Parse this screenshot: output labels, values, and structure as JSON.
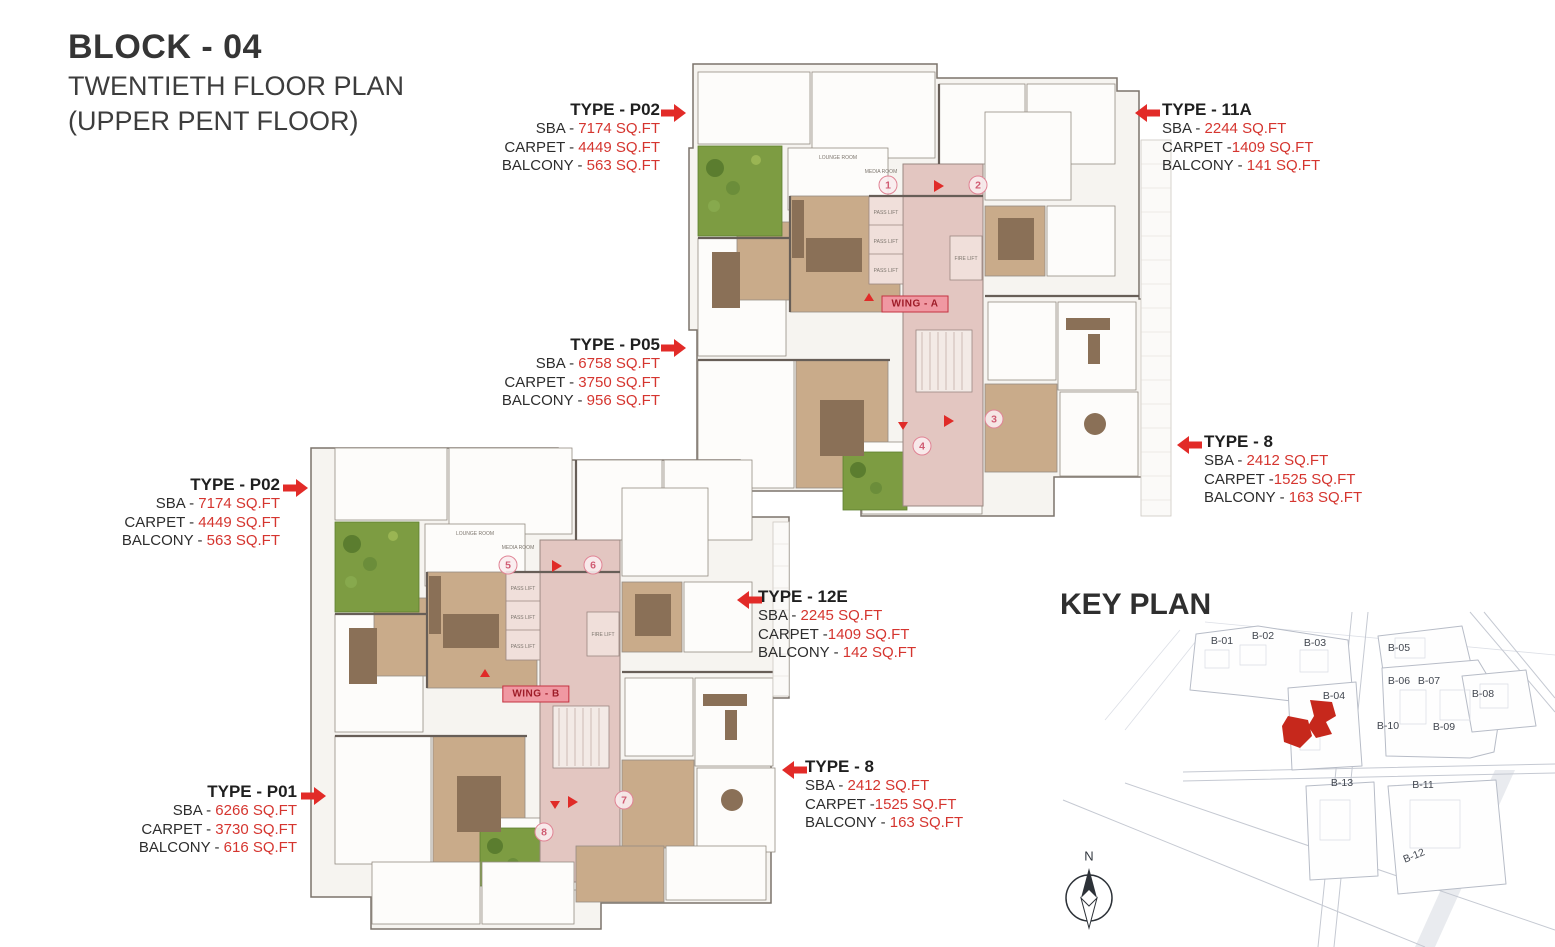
{
  "page": {
    "block_title": "BLOCK - 04",
    "floor_title": "TWENTIETH FLOOR PLAN",
    "floor_subtitle": "(UPPER PENT FLOOR)"
  },
  "callouts": [
    {
      "type": "TYPE - P02",
      "sba_label": "SBA - ",
      "sba_value": "7174 SQ.FT",
      "carpet_label": "CARPET - ",
      "carpet_value": "4449 SQ.FT",
      "balcony_label": "BALCONY - ",
      "balcony_value": "563 SQ.FT"
    },
    {
      "type": "TYPE - 11A",
      "sba_label": "SBA - ",
      "sba_value": "2244 SQ.FT",
      "carpet_label": "CARPET -",
      "carpet_value": "1409 SQ.FT",
      "balcony_label": "BALCONY - ",
      "balcony_value": "141 SQ.FT"
    },
    {
      "type": "TYPE - P05",
      "sba_label": "SBA - ",
      "sba_value": "6758 SQ.FT",
      "carpet_label": "CARPET - ",
      "carpet_value": "3750 SQ.FT",
      "balcony_label": "BALCONY - ",
      "balcony_value": "956 SQ.FT"
    },
    {
      "type": "TYPE - 8",
      "sba_label": "SBA - ",
      "sba_value": "2412 SQ.FT",
      "carpet_label": "CARPET -",
      "carpet_value": "1525 SQ.FT",
      "balcony_label": "BALCONY - ",
      "balcony_value": "163 SQ.FT"
    },
    {
      "type": "TYPE - P02",
      "sba_label": "SBA - ",
      "sba_value": "7174 SQ.FT",
      "carpet_label": "CARPET - ",
      "carpet_value": "4449 SQ.FT",
      "balcony_label": "BALCONY - ",
      "balcony_value": "563 SQ.FT"
    },
    {
      "type": "TYPE - 12E",
      "sba_label": "SBA - ",
      "sba_value": "2245 SQ.FT",
      "carpet_label": "CARPET -",
      "carpet_value": "1409 SQ.FT",
      "balcony_label": "BALCONY - ",
      "balcony_value": "142 SQ.FT"
    },
    {
      "type": "TYPE - 8",
      "sba_label": "SBA - ",
      "sba_value": "2412 SQ.FT",
      "carpet_label": "CARPET -",
      "carpet_value": "1525 SQ.FT",
      "balcony_label": "BALCONY - ",
      "balcony_value": "163 SQ.FT"
    },
    {
      "type": "TYPE - P01",
      "sba_label": "SBA - ",
      "sba_value": "6266 SQ.FT",
      "carpet_label": "CARPET - ",
      "carpet_value": "3730 SQ.FT",
      "balcony_label": "BALCONY - ",
      "balcony_value": "616 SQ.FT"
    }
  ],
  "plan": {
    "wing_a_label": "WING - A",
    "wing_b_label": "WING - B",
    "unit_markers": [
      "1",
      "2",
      "3",
      "4",
      "5",
      "6",
      "7",
      "8"
    ],
    "room_labels": {
      "media_room": "MEDIA ROOM",
      "lounge_room": "LOUNGE ROOM",
      "pass_lift": "PASS LIFT",
      "fire_lift": "FIRE LIFT"
    }
  },
  "keyplan": {
    "title": "KEY PLAN",
    "north_label": "N",
    "highlighted_block": "B-04",
    "blocks": [
      {
        "label": "B-01"
      },
      {
        "label": "B-02"
      },
      {
        "label": "B-03"
      },
      {
        "label": "B-04"
      },
      {
        "label": "B-05"
      },
      {
        "label": "B-06"
      },
      {
        "label": "B-07"
      },
      {
        "label": "B-08"
      },
      {
        "label": "B-09"
      },
      {
        "label": "B-10"
      },
      {
        "label": "B-11"
      },
      {
        "label": "B-12"
      },
      {
        "label": "B-13"
      }
    ]
  },
  "colors": {
    "accent_red": "#d5352f",
    "arrow_red": "#e22b28",
    "corridor_pink": "#e3c6c1",
    "wing_tag_bg": "#f098a2",
    "wing_tag_text": "#9e1c28",
    "terrace_green": "#7d9c42",
    "keyplan_highlight": "#c6281c",
    "text_dark": "#2d2d2d"
  }
}
